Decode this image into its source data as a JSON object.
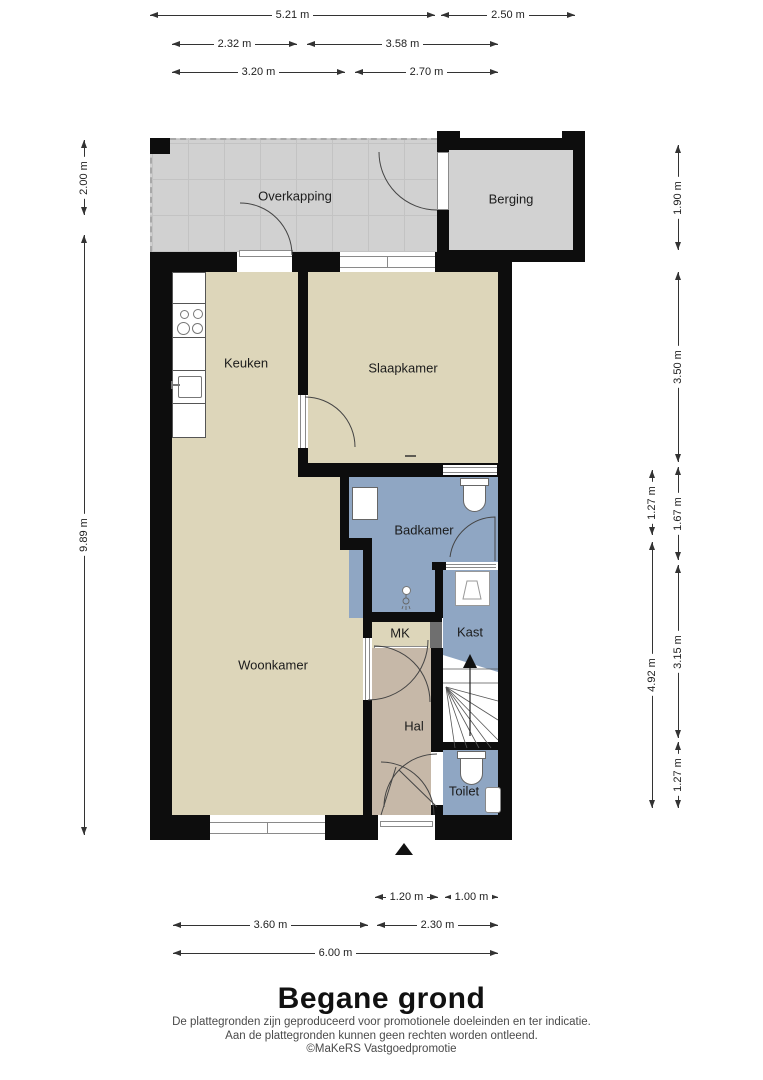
{
  "title": "Begane grond",
  "disclaimer": [
    "De plattegronden zijn geproduceerd voor promotionele doeleinden en ter indicatie.",
    "Aan de plattegronden kunnen geen rechten worden ontleend.",
    "©MaKeRS Vastgoedpromotie"
  ],
  "rooms": {
    "overkapping": "Overkapping",
    "berging": "Berging",
    "keuken": "Keuken",
    "slaapkamer": "Slaapkamer",
    "badkamer": "Badkamer",
    "mk": "MK",
    "kast": "Kast",
    "woonkamer": "Woonkamer",
    "hal": "Hal",
    "toilet": "Toilet"
  },
  "dimensions": {
    "top": [
      "5.21 m",
      "2.50 m",
      "2.32 m",
      "3.58 m",
      "3.20 m",
      "2.70 m"
    ],
    "bottom": [
      "1.20 m",
      "1.00 m",
      "3.60 m",
      "2.30 m",
      "6.00 m"
    ],
    "left": [
      "2.00 m",
      "9.89 m"
    ],
    "right_inner": [
      "1.27 m",
      "4.92 m"
    ],
    "right_outer": [
      "1.90 m",
      "3.50 m",
      "1.67 m",
      "3.15 m",
      "1.27 m"
    ]
  },
  "colors": {
    "wall": "#0d0d0d",
    "floor_living": "#ddd6ba",
    "floor_wet": "#8fa6c3",
    "floor_hall": "#c6b8a8",
    "floor_outdoor": "#d1d1d1",
    "floor_storage": "#d2d2d2"
  }
}
